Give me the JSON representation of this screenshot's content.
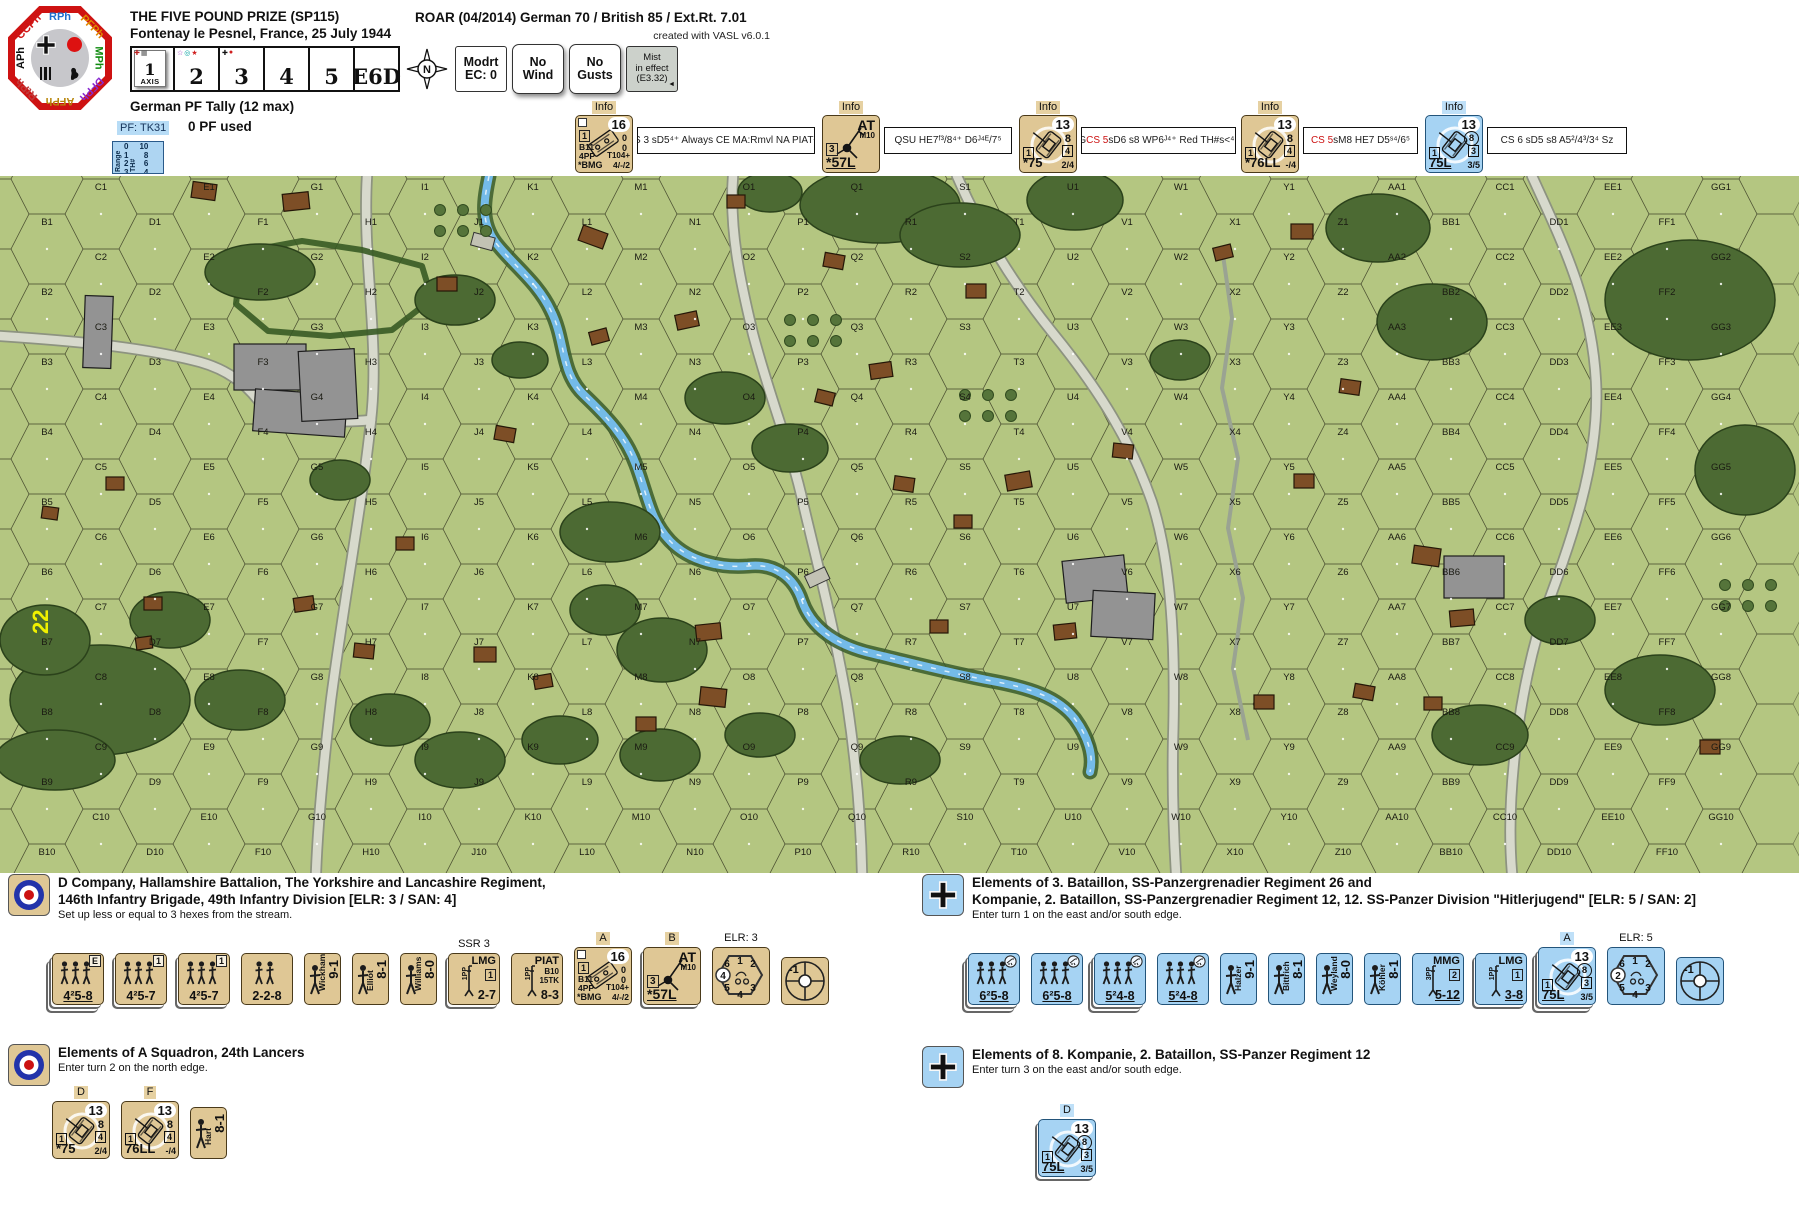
{
  "colors": {
    "british_tan": "#dfc795",
    "german_blue": "#a6d3f3",
    "accent_red": "#cc1111",
    "map_green": "#b4c681",
    "octagon_red": "#ce1212",
    "pf_blue": "#aed5f2"
  },
  "header": {
    "title": "THE FIVE POUND PRIZE (SP115)",
    "subtitle": "Fontenay le Pesnel, France, 25 July 1944",
    "roar": "ROAR (04/2014) German 70 / British 85 / Ext.Rt. 7.01",
    "credit": "created with VASL v6.0.1",
    "phases": [
      "RPh",
      "PFPh",
      "MPh",
      "DFPh",
      "AFPh",
      "RtPh",
      "APh",
      "CCPh"
    ],
    "turn_track": {
      "cells": [
        {
          "num": "1",
          "sub": "AXIS",
          "current": true,
          "markers": [
            {
              "glyph": "✚",
              "color": "#bb2222"
            },
            {
              "glyph": "▦",
              "color": "#555555"
            }
          ]
        },
        {
          "num": "2",
          "markers": [
            {
              "glyph": "☆",
              "color": "#9a30c0"
            },
            {
              "glyph": "◎",
              "color": "#00a0a0"
            },
            {
              "glyph": "★",
              "color": "#d02020"
            }
          ]
        },
        {
          "num": "3",
          "markers": [
            {
              "glyph": "✚",
              "color": "#111111"
            },
            {
              "glyph": "●",
              "color": "#d02020"
            }
          ]
        },
        {
          "num": "4"
        },
        {
          "num": "5"
        },
        {
          "num": "E6D"
        }
      ],
      "compass_letter": "N",
      "boxes": [
        {
          "lines": [
            "Modrt",
            "EC: 0"
          ]
        },
        {
          "lines": [
            "No",
            "Wind"
          ],
          "raised": true
        },
        {
          "lines": [
            "No",
            "Gusts"
          ],
          "raised": true
        },
        {
          "lines": [
            "Mist",
            "in effect",
            "(E3.32)"
          ],
          "style": "gray",
          "arrow": "◄"
        }
      ]
    },
    "pf_tally": {
      "title": "German PF Tally (12 max)",
      "code": "PF: TK31",
      "used": "0 PF used",
      "range_card": {
        "col_head": "Range",
        "th_head": "TH#",
        "rows": [
          [
            "0",
            "10"
          ],
          [
            "1",
            "8"
          ],
          [
            "2",
            "6"
          ],
          [
            "3",
            "4"
          ]
        ]
      }
    },
    "info_strip": [
      {
        "tag": "Info",
        "counter": {
          "kind": "carrier",
          "tr": "16",
          "right": [
            "0",
            "0"
          ],
          "l1": "1",
          "left": [
            "B11",
            "4PP"
          ],
          "bl": "*BMG",
          "brt": "T104+",
          "br": "4/-/2"
        },
        "text": {
          "pre": "CS 3  sD5⁴⁺  Always CE  MA:Rmvl NA  PIATᴶ³⁺"
        }
      },
      {
        "tag": "Info",
        "counter": {
          "kind": "gun",
          "tr": "AT",
          "tr2": "M10",
          "l1": "3",
          "bl": "*57L"
        },
        "text": {
          "pre": "QSU  HE7ᶠ³/8⁴⁺  D6ᴶ⁴ᴱ/7⁵"
        }
      },
      {
        "tag": "Info",
        "counter": {
          "kind": "tank",
          "tr": "13",
          "mp": "8",
          "r2": "4",
          "l1": "1",
          "bl": "*75",
          "br": "2/4"
        },
        "text": {
          "pre": "G  ",
          "accent": "CS 5",
          "post": "  sD6  s8  WP6ᴶ⁴⁺  Red TH#s˂⁴⁴"
        }
      },
      {
        "tag": "Info",
        "counter": {
          "kind": "tank",
          "tr": "13",
          "mp": "8",
          "r2": "4",
          "l1": "1",
          "bl": "*76LL",
          "br": "-/4"
        },
        "text": {
          "accent": "CS 5",
          "post": "  sM8  HE7  D5ˢ⁴/6⁵"
        }
      },
      {
        "tag": "Info",
        "counter": {
          "kind": "tank",
          "blue": true,
          "tr": "13",
          "mp": "8",
          "mpCircled": true,
          "r2": "3",
          "l1": "1",
          "bl": "75L",
          "blU": true,
          "br": "3/5"
        },
        "text": {
          "pre": "CS 6  sD5  s8  A5²/4³/3⁴  Sz"
        }
      }
    ]
  },
  "map": {
    "board_number": "22",
    "columns": [
      "A",
      "B",
      "C",
      "D",
      "E",
      "F",
      "G",
      "H",
      "I",
      "J",
      "K",
      "L",
      "M",
      "N",
      "O",
      "P",
      "Q",
      "R",
      "S",
      "T",
      "U",
      "V",
      "W",
      "X",
      "Y",
      "Z",
      "AA",
      "BB",
      "CC",
      "DD",
      "EE",
      "FF",
      "GG",
      "HH"
    ],
    "rows": 10
  },
  "sections": {
    "british": {
      "title1": "D Company, Hallamshire Battalion, The Yorkshire and Lancashire Regiment,",
      "title2": "146th Infantry Brigade, 49th Infantry Division [ELR: 3 / SAN: 4]",
      "note": "Set up less or equal to 3 hexes from the stream.",
      "counters": [
        {
          "kind": "squad",
          "stack": 3,
          "badge": "E",
          "value": "4²5-8",
          "u": true
        },
        {
          "kind": "squad",
          "stack": 2,
          "badge": "1",
          "value": "4²5-7"
        },
        {
          "kind": "squad",
          "stack": 2,
          "badge": "1",
          "value": "4²5-7"
        },
        {
          "kind": "crew",
          "value": "2-2-8"
        },
        {
          "kind": "leader",
          "name": "Wickham",
          "value": "9-1"
        },
        {
          "kind": "leader",
          "name": "Elliot",
          "value": "8-1"
        },
        {
          "kind": "leader",
          "name": "Williams",
          "value": "8-0"
        },
        {
          "kind": "sw",
          "label": "SSR 3",
          "title": "LMG",
          "pp": "1PP",
          "box": "1",
          "value": "2-7",
          "stack": 2
        },
        {
          "kind": "piat",
          "title": "PIAT",
          "pp": "1PP",
          "lines": [
            "B10",
            "15TK"
          ],
          "value": "8-3"
        },
        {
          "kind": "carrier",
          "label": "A",
          "tr": "16",
          "right": [
            "0",
            "0"
          ],
          "l1": "1",
          "left": [
            "B11",
            "4PP"
          ],
          "bl": "*BMG",
          "brt": "T104+",
          "br": "4/-/2"
        },
        {
          "kind": "gun",
          "label": "B",
          "tr": "AT",
          "tr2": "M10",
          "l1": "3",
          "bl": "*57L",
          "stack": 2
        },
        {
          "kind": "turret",
          "label": "ELR: 3",
          "nums": [
            "6",
            "1",
            "2",
            "5",
            "4",
            "3"
          ],
          "circled": "4"
        },
        {
          "kind": "sniper",
          "value": "-1"
        }
      ]
    },
    "lancers": {
      "title": "Elements of A Squadron, 24th Lancers",
      "note": "Enter turn 2 on the north edge.",
      "counters": [
        {
          "kind": "tank",
          "label": "D",
          "tr": "13",
          "mp": "8",
          "r2": "4",
          "l1": "1",
          "bl": "*75",
          "br": "2/4"
        },
        {
          "kind": "tank",
          "label": "F",
          "tr": "13",
          "mp": "8",
          "r2": "4",
          "l1": "1",
          "bl": "76LL",
          "br": "-/4"
        },
        {
          "kind": "leader",
          "name": "Hart",
          "value": "8-1"
        }
      ]
    },
    "german1": {
      "title1": "Elements of 3. Bataillon, SS-Panzergrenadier Regiment 26 and",
      "title2": "Kompanie, 2. Bataillon, SS-Panzergrenadier Regiment 12, 12. SS-Panzer Division \"Hitlerjugend\" [ELR: 5 / SAN: 2]",
      "note": "Enter turn 1 on the east and/or south edge.",
      "counters": [
        {
          "kind": "squad",
          "blue": true,
          "stack": 3,
          "mg": true,
          "value": "6²5-8",
          "u": true
        },
        {
          "kind": "squad",
          "blue": true,
          "mg": true,
          "value": "6²5-8",
          "u": true
        },
        {
          "kind": "squad",
          "blue": true,
          "stack": 3,
          "mg": true,
          "value": "5²4-8",
          "u": true
        },
        {
          "kind": "squad",
          "blue": true,
          "mg": true,
          "value": "5²4-8",
          "u": true
        },
        {
          "kind": "leader",
          "blue": true,
          "name": "Halzer",
          "value": "9-1"
        },
        {
          "kind": "leader",
          "blue": true,
          "name": "Bittrich",
          "value": "8-1"
        },
        {
          "kind": "leader",
          "blue": true,
          "name": "Weyland",
          "value": "8-0"
        },
        {
          "kind": "leader",
          "blue": true,
          "name": "Köhler",
          "value": "8-1"
        },
        {
          "kind": "sw",
          "blue": true,
          "title": "MMG",
          "pp": "3PP",
          "box": "2",
          "value": "5-12",
          "u": true
        },
        {
          "kind": "sw",
          "blue": true,
          "title": "LMG",
          "pp": "1PP",
          "box": "1",
          "value": "3-8",
          "u": true,
          "stack": 2
        },
        {
          "kind": "tank",
          "blue": true,
          "label": "A",
          "tr": "13",
          "mp": "8",
          "mpCircled": true,
          "r2": "3",
          "l1": "1",
          "bl": "75L",
          "blU": true,
          "br": "3/5",
          "stack": 3
        },
        {
          "kind": "turret",
          "blue": true,
          "label": "ELR: 5",
          "nums": [
            "6",
            "1",
            "2",
            "5",
            "4",
            "3"
          ],
          "circled": "2"
        },
        {
          "kind": "sniper",
          "blue": true,
          "value": "-1"
        }
      ]
    },
    "german2": {
      "title": "Elements of 8. Kompanie, 2. Bataillon, SS-Panzer Regiment 12",
      "note": "Enter turn 3 on the east and/or south edge.",
      "counters": [
        {
          "kind": "tank",
          "blue": true,
          "label": "D",
          "tr": "13",
          "mp": "8",
          "mpCircled": true,
          "r2": "3",
          "l1": "1",
          "bl": "75L",
          "blU": true,
          "br": "3/5",
          "stack": 2
        }
      ]
    }
  }
}
